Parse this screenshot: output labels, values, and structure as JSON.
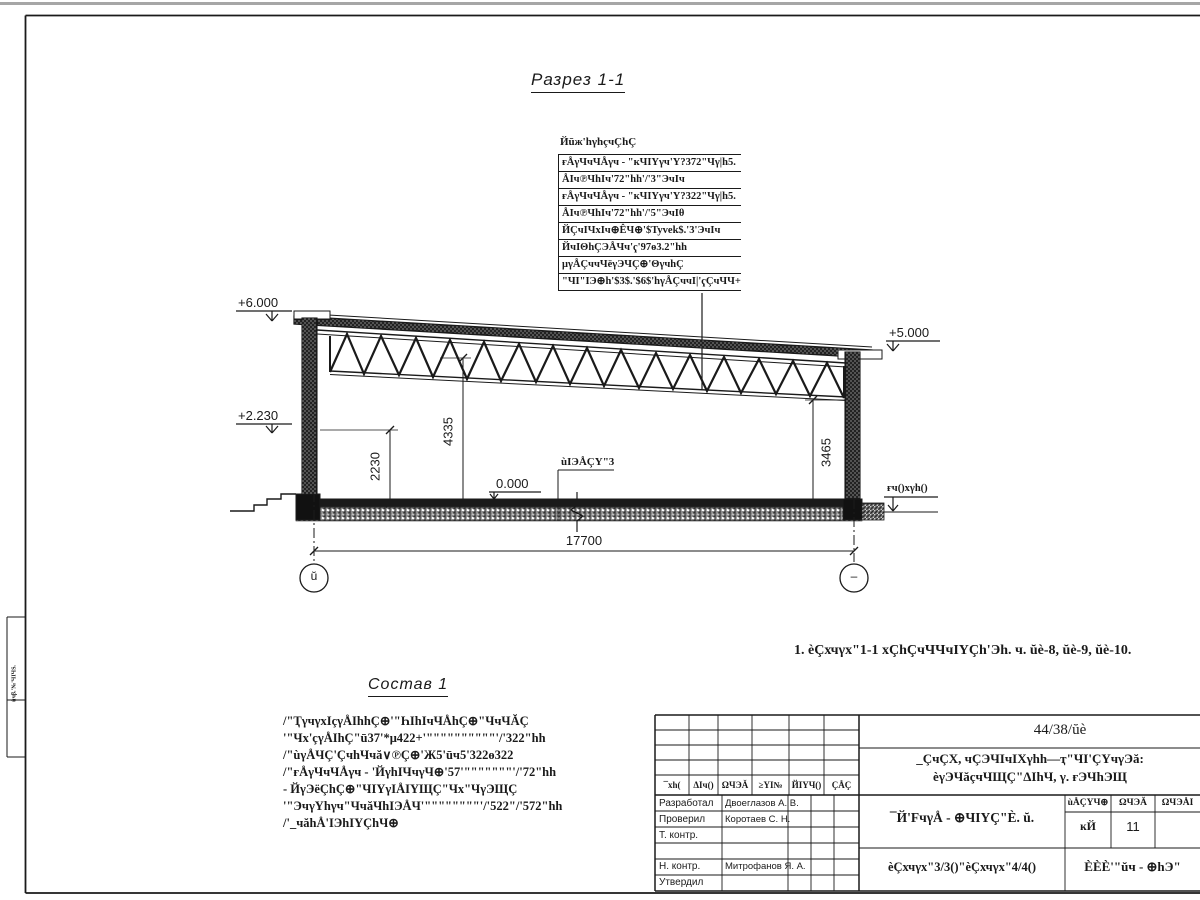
{
  "drawing": {
    "section_title": "Разрез 1-1",
    "spec": {
      "title": "Йūж'hγhçчÇhÇ",
      "rows": [
        "ғÅγЧчЧÅγч - \"кЧIҮγч'Ү?372\"Чγ|h5.",
        "ÅIч℗ЧhIч'72\"hh'/'3\"ЭчIч",
        "ғÅγЧчЧÅγч - \"кЧIҮγч'Ү?322\"Чγ|h5.",
        "ÅIч℗ЧhIч'72\"hh'/'5\"ЭчIθ",
        "ЙÇчIЧхIч⊕ÊЧ⊕'$Tyvek$.'3'ЭчIч",
        "ЙчIΘhÇЭÅЧч'ҁ'97ө3.2\"hh",
        "μγÅÇччЧёγЭЧÇ⊕'ΘγчhÇ",
        "\"ЧI\"IЭ⊕h'$3$.'$6$'hγÅÇччI|'ҁÇчЧЧ+"
      ]
    },
    "elevations": {
      "top_left": "+6.000",
      "mid_left": "+2.230",
      "top_right": "+5.000",
      "zero": "0.000",
      "ground": "ғч()хγh()"
    },
    "dimensions": {
      "h1": "2230",
      "h2": "4335",
      "h3": "3465",
      "span": "17700"
    },
    "floor_label": "ùIЭÅÇҮ\"3",
    "grid_bubbles": {
      "left": "ŭ",
      "right": "–"
    },
    "note": "1. èÇхчγх\"1-1 хÇhÇчЧЧчIҮÇh'Эh. ч. ŭè-8, ŭè-9, ŭè-10.",
    "composition": {
      "title": "Состав 1",
      "lines": [
        "/\"ҬγчγхIçγÅIhhÇ⊕'\"ҺIhIчЧÅhÇ⊕\"ЧчЧĂÇ",
        "'\"Чх'çγÅIhÇ\"ū37'*μ422+'\"\"\"\"\"\"\"\"\"\"'/'322\"hh",
        "/\"ùγÅЧÇ'ÇчhЧчă∨℗Ç⊕'Ж5'ūч5'322ө322",
        "/\"ғÅγЧчЧÅγч - 'ЙγhIЧчγЧ⊕'57'\"\"\"\"\"\"\"'/'72\"hh",
        "- ЙγЭёÇhÇ⊕\"ЧIҮγIÅIҮЩÇ\"Чх\"ЧγЭЩÇ",
        "'\"ЭчγҮhγч\"ЧчăЧhIЭÅЧ'\"\"\"\"\"\"\"\"'/'522\"/'572\"hh",
        "/'_чăhÅ'IЭhIҮÇhЧ⊕"
      ]
    },
    "edge_stamp_text": "ùчβ.'№'ЧIЧЅ."
  },
  "titleblock": {
    "doc_number": "44/38/ŭè",
    "project_name_line1": "_ÇчÇХ, чÇЭЧIчIХγhh—ҭ\"ЧI'ÇҮчγЭă:",
    "project_name_line2": "èγЭЧăçчЧЩÇ\"ΔIhЧ, γ. ғЭЧhЭЩ",
    "sheet_name": "¯Й'FчγÅ - ⊕ЧIҮÇ\"È. ŭ.",
    "sheets_label": "èÇхчγх\"3/3()\"èÇхчγх\"4/4()",
    "company": "ÈÈÈ'\"ŭч - ⊕hЭ\"",
    "header_cols": [
      "¯хh(",
      "ΔIч()",
      "ΩЧЭĂ",
      "≥ҮI№",
      "ЙIҮЧ()",
      "ÇÅÇ"
    ],
    "mini_table": {
      "headers": [
        "ùÅÇҮЧ⊕",
        "ΩЧЭĂ",
        "ΩЧЭÅI"
      ],
      "values": [
        "ĸЙ",
        "11",
        ""
      ]
    },
    "roles": [
      {
        "role": "Разработал",
        "name": "Двоеглазов А. В."
      },
      {
        "role": "Проверил",
        "name": "Коротаев С. Н."
      },
      {
        "role": "Т. контр.",
        "name": ""
      },
      {
        "role": "",
        "name": ""
      },
      {
        "role": "Н. контр.",
        "name": "Митрофанов Я. А."
      },
      {
        "role": "Утвердил",
        "name": ""
      }
    ]
  }
}
